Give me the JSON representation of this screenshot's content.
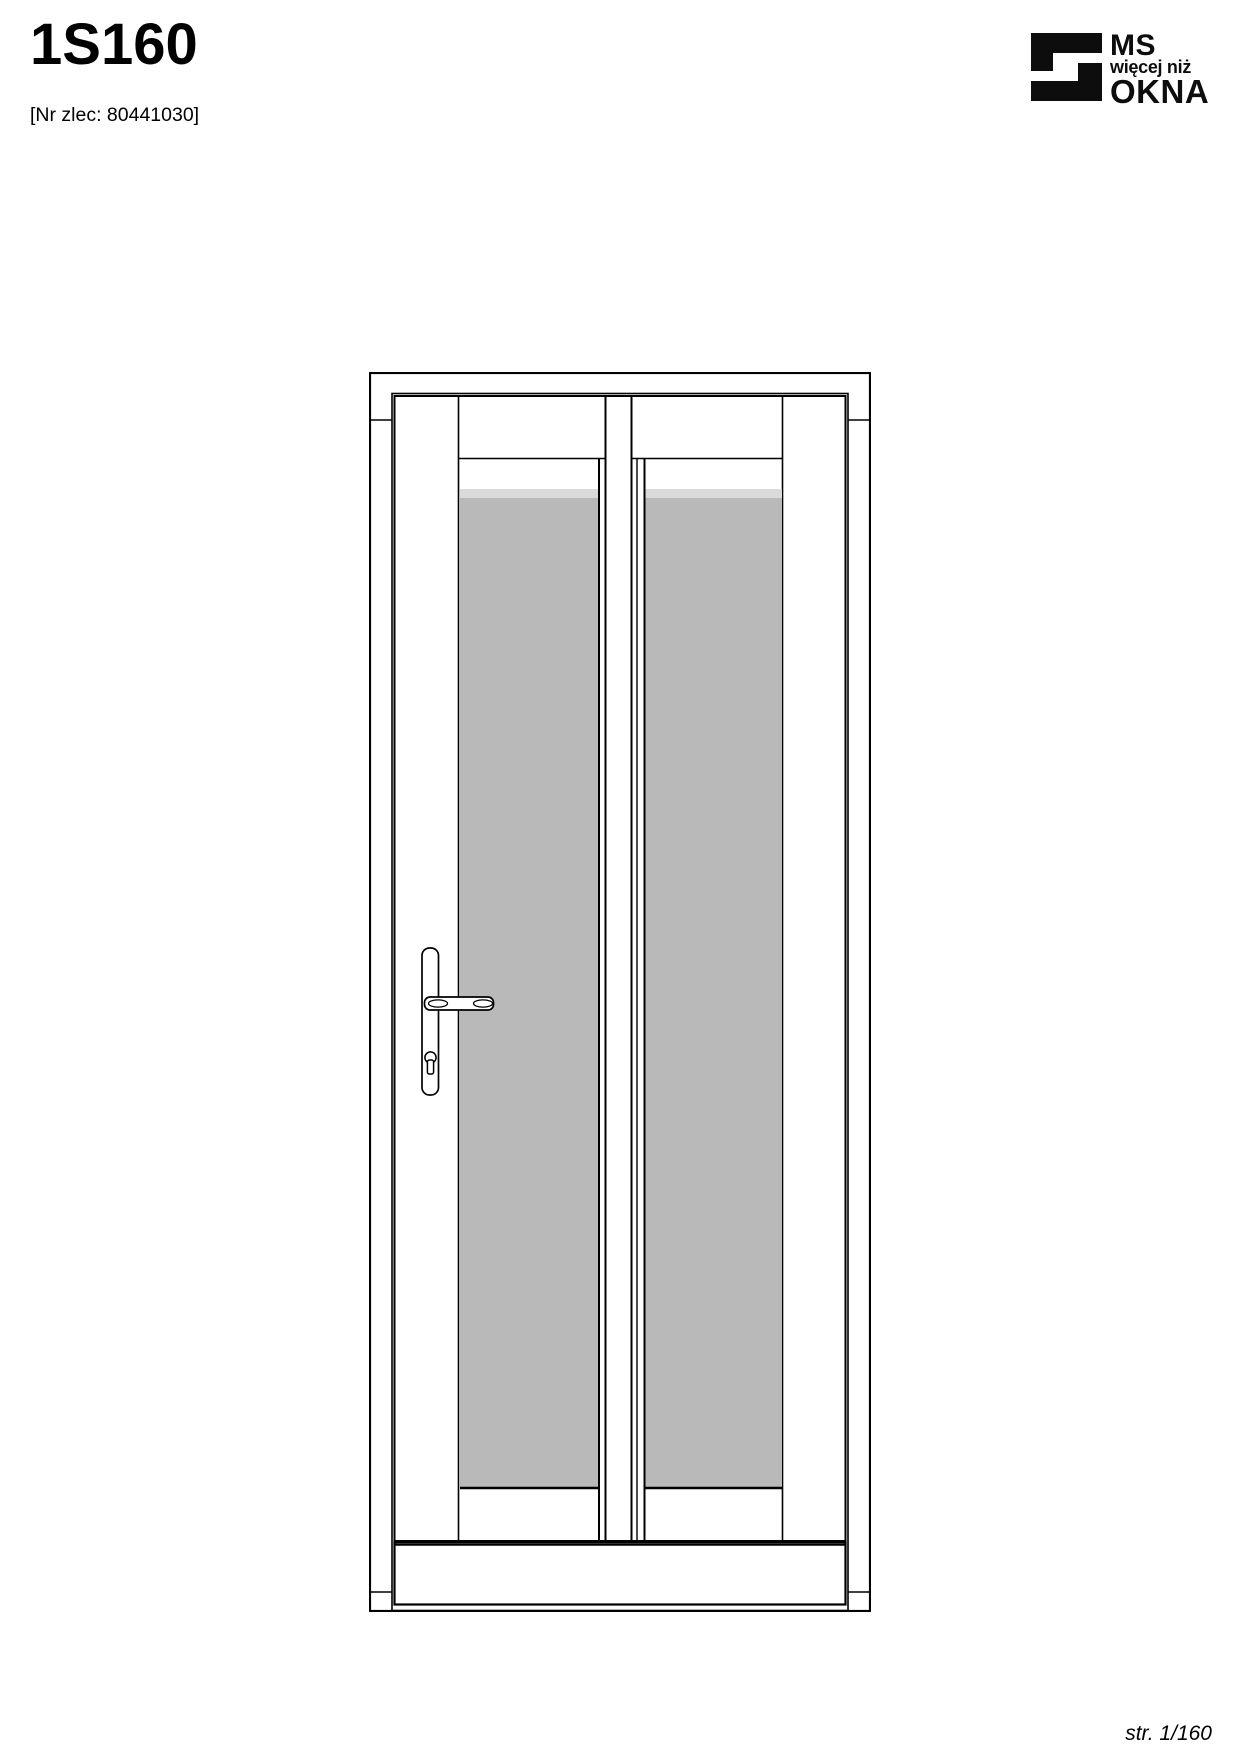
{
  "header": {
    "title": "1S160",
    "order_ref": "[Nr zlec: 80441030]"
  },
  "logo": {
    "line1": "MS",
    "line2": "więcej niż",
    "line3": "OKNA"
  },
  "drawing": {
    "kind": "door-elevation-technical-drawing",
    "colors": {
      "line": "#000000",
      "glass": "#b9b9b9",
      "glass_highlight": "#dadada",
      "surface": "#ffffff"
    }
  },
  "footer": {
    "page_label": "str. 1/160"
  }
}
